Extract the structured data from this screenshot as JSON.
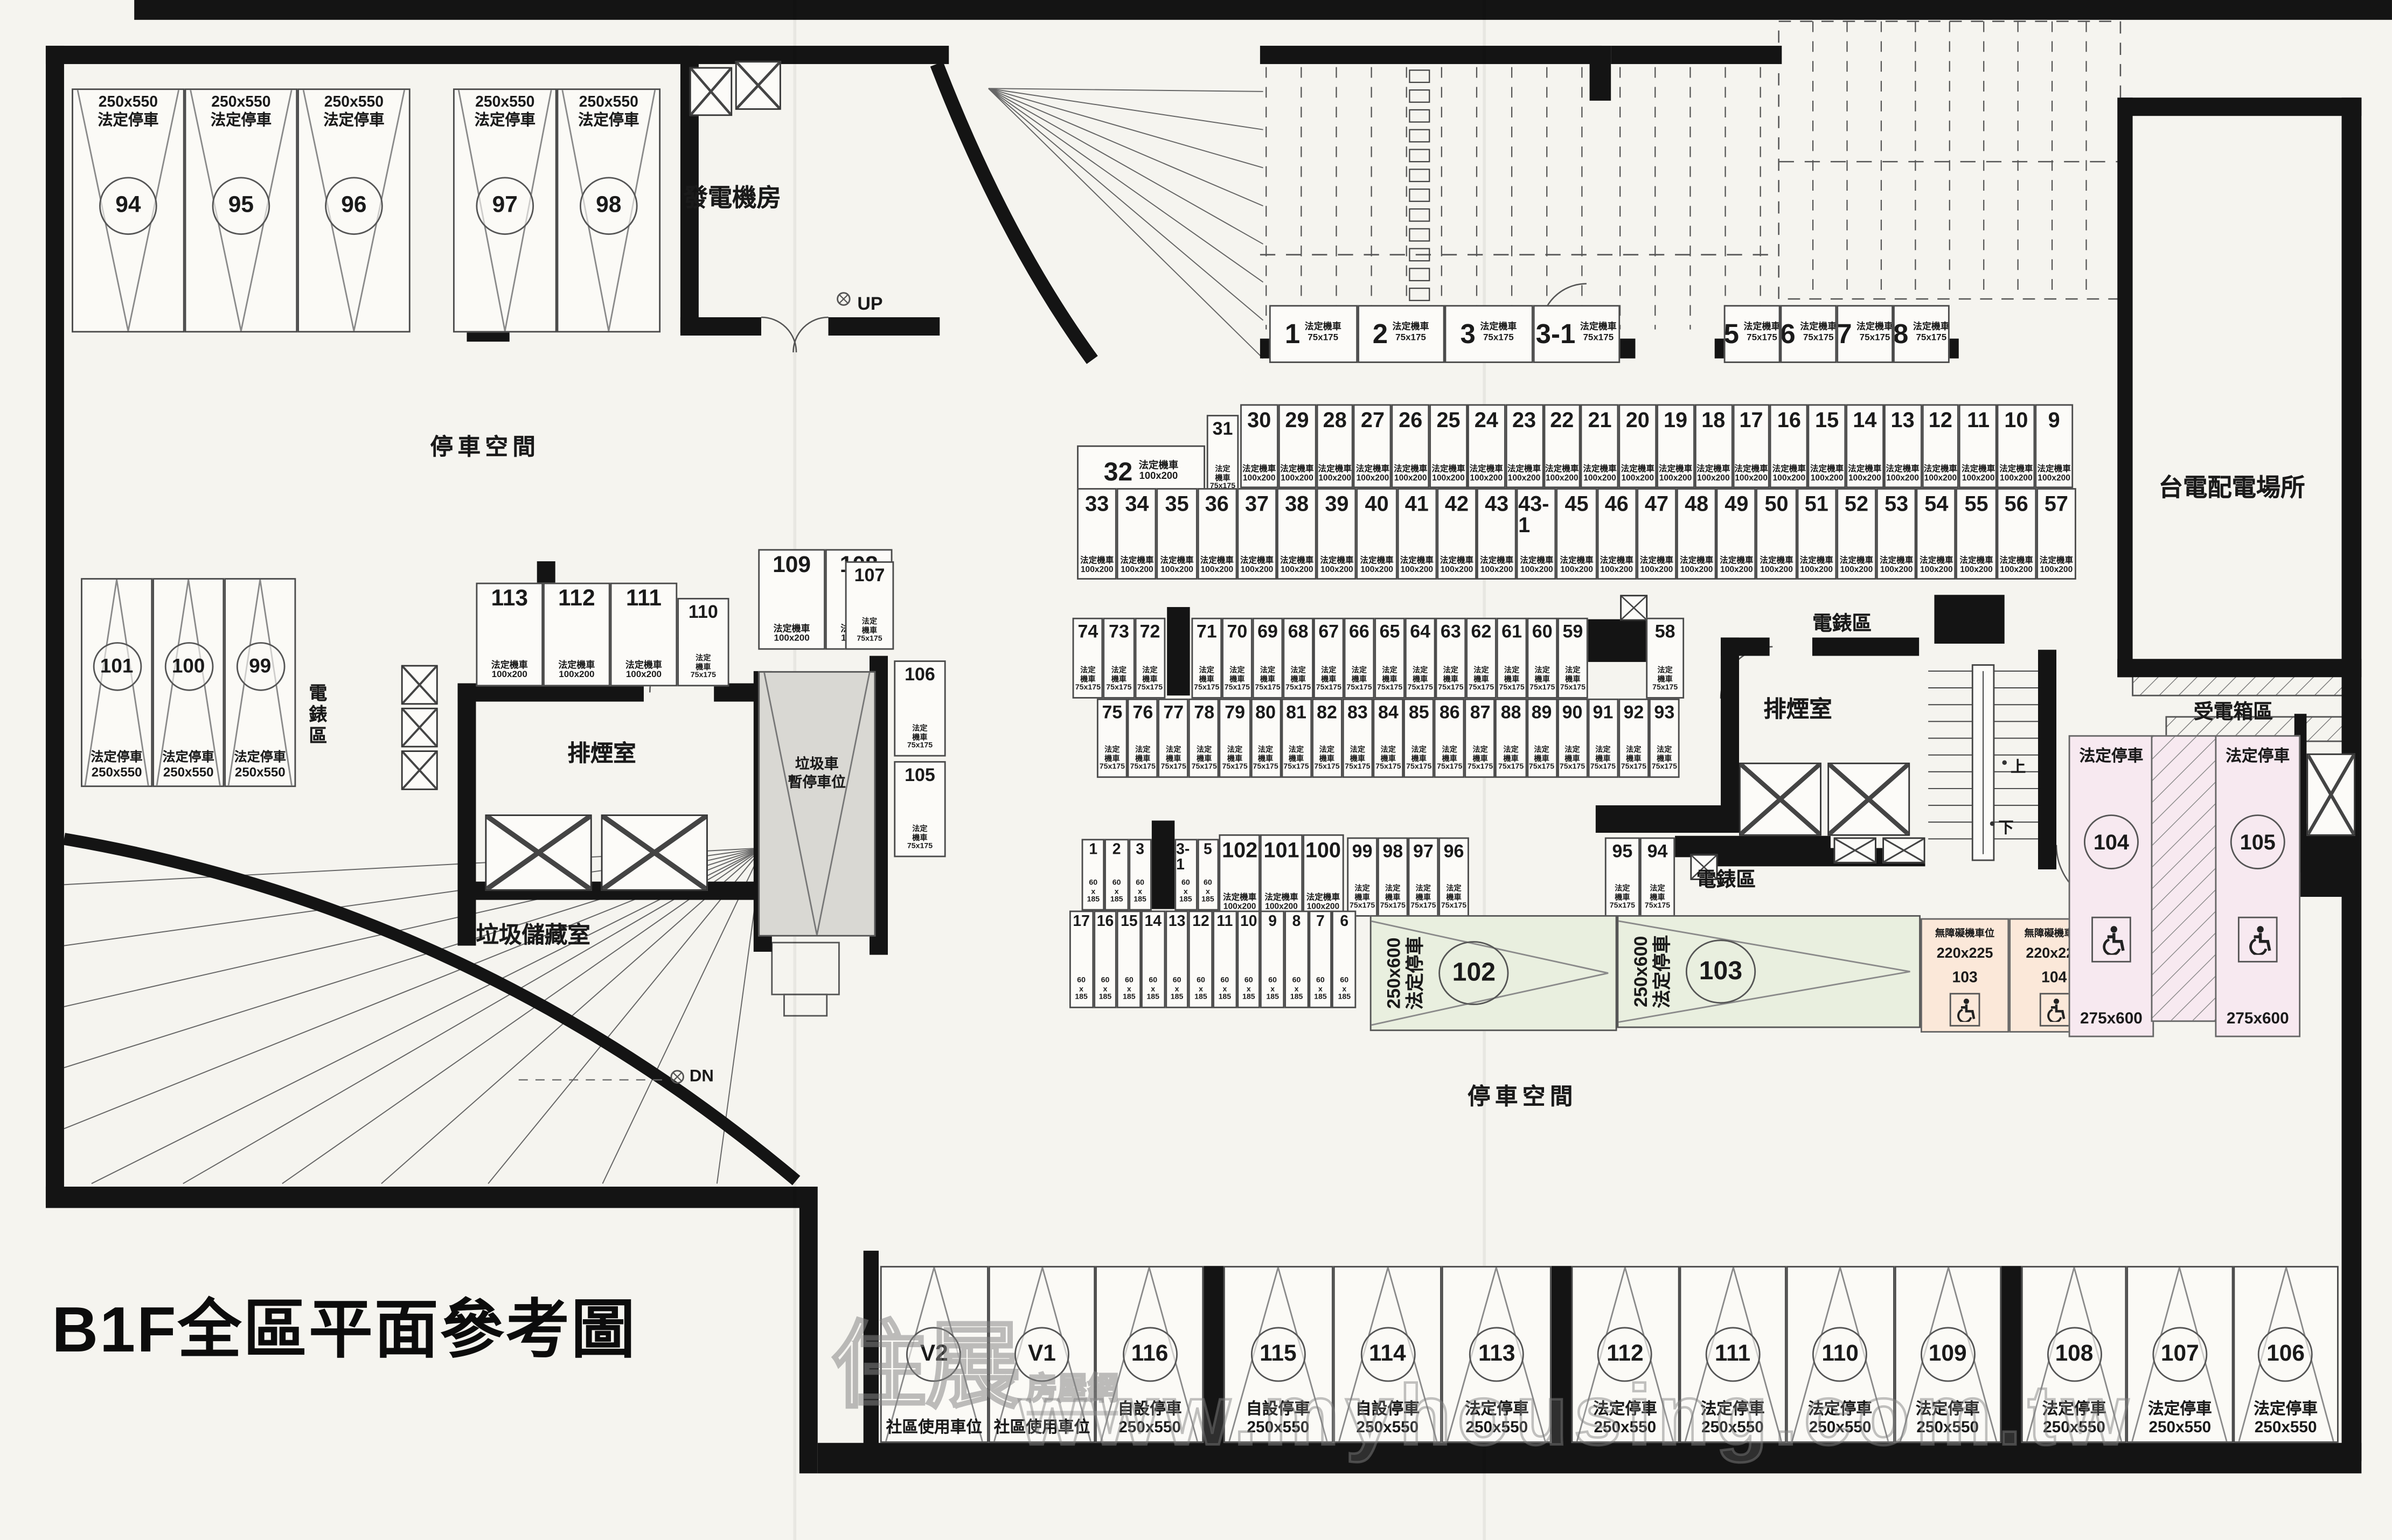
{
  "title": "B1F全區平面參考圖",
  "watermark": {
    "logo_main": "住展",
    "logo_sub": "房屋網",
    "url": "www.myhousing.com.tw"
  },
  "legend": {
    "statutory_car": "法定停車",
    "statutory_moto": "法定機車",
    "moto_l1": "法定",
    "moto_l2": "機車",
    "self_car": "自設停車",
    "community": "社區使用車位",
    "accessible_moto": "無障礙機車位"
  },
  "labels": {
    "parking_space_left": "停車空間",
    "parking_space_center": "停車空間",
    "generator_room": "發電機房",
    "smoke_room_left": "排煙室",
    "smoke_room_right": "排煙室",
    "meter_area_left": "電錶區",
    "meter_area_center": "電錶區",
    "meter_area_right": "電錶區",
    "garbage_truck_line1": "垃圾車",
    "garbage_truck_line2": "暫停車位",
    "garbage_storage": "垃圾儲藏室",
    "taipower_room": "台電配電場所",
    "power_box_area": "受電箱區",
    "up": "UP",
    "dn": "DN",
    "stair_up": "上",
    "stair_down": "下"
  },
  "car_stalls": {
    "top_left": [
      {
        "id": "94",
        "type": "法定停車",
        "dim": "250x550"
      },
      {
        "id": "95",
        "type": "法定停車",
        "dim": "250x550"
      },
      {
        "id": "96",
        "type": "法定停車",
        "dim": "250x550"
      },
      {
        "id": "97",
        "type": "法定停車",
        "dim": "250x550"
      },
      {
        "id": "98",
        "type": "法定停車",
        "dim": "250x550"
      }
    ],
    "mid_left": [
      {
        "id": "101",
        "type": "法定停車",
        "dim": "250x550"
      },
      {
        "id": "100",
        "type": "法定停車",
        "dim": "250x550"
      },
      {
        "id": "99",
        "type": "法定停車",
        "dim": "250x550"
      }
    ],
    "bottom_g1": [
      {
        "id": "V2",
        "label": "社區使用車位"
      },
      {
        "id": "V1",
        "label": "社區使用車位"
      },
      {
        "id": "116",
        "type": "自設停車",
        "dim": "250x550"
      }
    ],
    "bottom_g2": [
      {
        "id": "115",
        "type": "自設停車",
        "dim": "250x550"
      },
      {
        "id": "114",
        "type": "自設停車",
        "dim": "250x550"
      },
      {
        "id": "113",
        "type": "法定停車",
        "dim": "250x550"
      }
    ],
    "bottom_g3": [
      {
        "id": "112",
        "type": "法定停車",
        "dim": "250x550"
      },
      {
        "id": "111",
        "type": "法定停車",
        "dim": "250x550"
      },
      {
        "id": "110",
        "type": "法定停車",
        "dim": "250x550"
      },
      {
        "id": "109",
        "type": "法定停車",
        "dim": "250x550"
      }
    ],
    "bottom_g4": [
      {
        "id": "108",
        "type": "法定停車",
        "dim": "250x550"
      },
      {
        "id": "107",
        "type": "法定停車",
        "dim": "250x550"
      },
      {
        "id": "106",
        "type": "法定停車",
        "dim": "250x550"
      }
    ],
    "large_center": [
      {
        "id": "102",
        "type": "法定停車",
        "dim": "250x600"
      },
      {
        "id": "103",
        "type": "法定停車",
        "dim": "250x600"
      }
    ],
    "accessible_car": [
      {
        "id": "104",
        "type": "法定停車",
        "dim": "275x600"
      },
      {
        "id": "105",
        "type": "法定停車",
        "dim": "275x600"
      }
    ]
  },
  "moto_stalls": {
    "row_a_left": {
      "dim": "75x175",
      "ids": [
        "1",
        "2",
        "3",
        "3-1"
      ]
    },
    "row_a_right": {
      "dim": "75x175",
      "ids": [
        "5",
        "6",
        "7",
        "8"
      ]
    },
    "cell_32": {
      "dim": "100x200",
      "ids": [
        "32"
      ]
    },
    "cell_31": {
      "dim": "75x175",
      "ids": [
        "31"
      ]
    },
    "row_b_top": {
      "dim": "100x200",
      "ids": [
        "30",
        "29",
        "28",
        "27",
        "26",
        "25",
        "24",
        "23",
        "22",
        "21",
        "20",
        "19",
        "18",
        "17",
        "16",
        "15",
        "14",
        "13",
        "12",
        "11",
        "10",
        "9"
      ]
    },
    "row_b_bottom": {
      "dim": "100x200",
      "ids": [
        "33",
        "34",
        "35",
        "36",
        "37",
        "38",
        "39",
        "40",
        "41",
        "42",
        "43",
        "43-1",
        "45",
        "46",
        "47",
        "48",
        "49",
        "50",
        "51",
        "52",
        "53",
        "54",
        "55",
        "56",
        "57"
      ]
    },
    "row_c_top_a": {
      "dim": "75x175",
      "ids": [
        "74",
        "73",
        "72"
      ]
    },
    "row_c_top_b": {
      "dim": "75x175",
      "ids": [
        "71",
        "70",
        "69",
        "68",
        "67",
        "66",
        "65",
        "64",
        "63",
        "62",
        "61",
        "60",
        "59"
      ]
    },
    "cell_58": {
      "dim": "75x175",
      "ids": [
        "58"
      ]
    },
    "row_c_bottom": {
      "dim": "75x175",
      "ids": [
        "75",
        "76",
        "77",
        "78",
        "79",
        "80",
        "81",
        "82",
        "83",
        "84",
        "85",
        "86",
        "87",
        "88",
        "89",
        "90",
        "91",
        "92",
        "93"
      ]
    },
    "row_d_a": {
      "dim": "60x185",
      "ids": [
        "1",
        "2",
        "3"
      ]
    },
    "row_d_b": {
      "dim": "60x185",
      "ids": [
        "3-1",
        "5"
      ]
    },
    "row_d_c": {
      "dim": "100x200",
      "ids": [
        "102",
        "101",
        "100"
      ]
    },
    "row_d_d": {
      "dim": "75x175",
      "ids": [
        "99",
        "98",
        "97",
        "96"
      ]
    },
    "row_d_e": {
      "dim": "75x175",
      "ids": [
        "95",
        "94"
      ]
    },
    "row_d_bottom": {
      "dim": "60x185",
      "ids": [
        "17",
        "16",
        "15",
        "14",
        "13",
        "12",
        "11",
        "10",
        "9",
        "8",
        "7",
        "6"
      ]
    },
    "cluster_a": {
      "dim": "100x200",
      "ids": [
        "113",
        "112",
        "111"
      ]
    },
    "cluster_b": {
      "dim": "75x175",
      "ids": [
        "110"
      ]
    },
    "cluster_c": {
      "dim": "100x200",
      "ids": [
        "109",
        "108"
      ]
    },
    "cluster_d": {
      "dim": "75x175",
      "ids": [
        "107"
      ]
    },
    "cluster_e": {
      "dim": "75x175",
      "ids": [
        "106"
      ]
    },
    "cluster_f": {
      "dim": "75x175",
      "ids": [
        "105"
      ]
    },
    "accessible": [
      {
        "id": "103",
        "dim": "220x225"
      },
      {
        "id": "104",
        "dim": "220x225"
      }
    ]
  }
}
